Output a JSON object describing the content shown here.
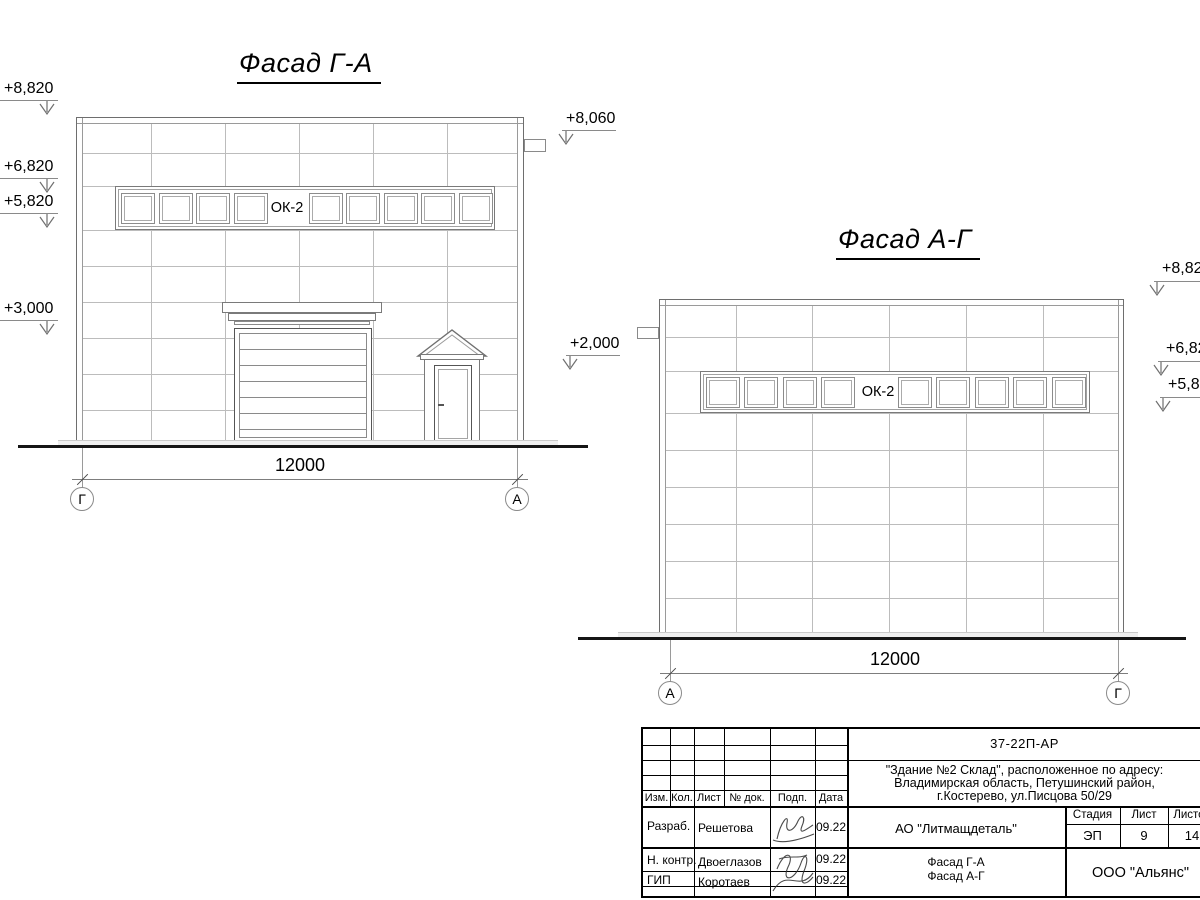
{
  "sheet": {
    "facade_ga": {
      "title": "Фасад Г-А",
      "window_band_label": "ОК-2",
      "levels": {
        "l8820": "+8,820",
        "l6820": "+6,820",
        "l5820": "+5,820",
        "l3000": "+3,000",
        "r8060": "+8,060",
        "r2000": "+2,000"
      },
      "dimension": "12000",
      "axis_left": "Г",
      "axis_right": "А"
    },
    "facade_ag": {
      "title": "Фасад А-Г",
      "window_band_label": "ОК-2",
      "levels": {
        "r8820": "+8,820",
        "r6820": "+6,820",
        "r5820": "+5,820"
      },
      "dimension": "12000",
      "axis_left": "А",
      "axis_right": "Г"
    },
    "titleblock": {
      "doc_code": "37-22П-АР",
      "project_lines": [
        "\"Здание №2 Склад\", расположенное по адресу:",
        "Владимирская область, Петушинский район,",
        "г.Костерево, ул.Писцова 50/29"
      ],
      "client": "АО \"Литмащдеталь\"",
      "sheet_name_line1": "Фасад Г-А",
      "sheet_name_line2": "Фасад А-Г",
      "organization": "ООО \"Альянс\"",
      "columns": {
        "izm": "Изм.",
        "kol": "Кол.",
        "list": "Лист",
        "doc": "№ док.",
        "podp": "Подп.",
        "data": "Дата"
      },
      "stage_header": "Стадия",
      "sheet_header": "Лист",
      "sheets_header": "Листов",
      "stage": "ЭП",
      "sheet_no": "9",
      "sheets_total": "14",
      "row_developed_label": "Разраб.",
      "row_developed_name": "Решетова",
      "row_developed_date": "09.22",
      "row_ncontrol_label": "Н. контр.",
      "row_ncontrol_name": "Двоеглазов",
      "row_ncontrol_date": "09.22",
      "row_gip_label": "ГИП",
      "row_gip_name": "Коротаев",
      "row_gip_date": "09.22"
    }
  }
}
